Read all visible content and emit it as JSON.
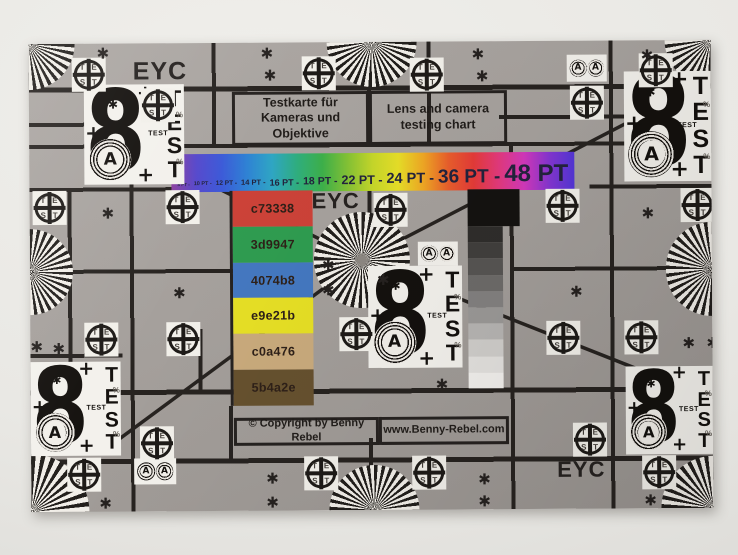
{
  "wall_color": "#ecebe7",
  "chart": {
    "background": "#a6a19d",
    "ink": "#262220",
    "eyc_label": "EYC",
    "title_de": {
      "line1": "Testkarte für",
      "line2": "Kameras und Objektive"
    },
    "title_en": {
      "line1": "Lens and camera",
      "line2": "testing chart"
    },
    "font_size_bar": {
      "labels": [
        "8 PT",
        "10 PT",
        "12 PT",
        "14 PT",
        "16 PT",
        "18 PT",
        "22 PT",
        "24 PT",
        "36 PT",
        "48 PT"
      ],
      "separator": "-",
      "text_color": "#23233d",
      "gradient_colors": [
        "#8b3f9e",
        "#5548cc",
        "#3c5ad8",
        "#2f82d4",
        "#2fa6c4",
        "#2fae7e",
        "#3db04a",
        "#84c235",
        "#c6d72a",
        "#e7df28",
        "#f0a824",
        "#ea5e2c",
        "#e53b38",
        "#e43a7e",
        "#d439bc",
        "#8636d2",
        "#5336d8"
      ]
    },
    "color_patches": [
      {
        "label": "c73338",
        "color": "#cc4238"
      },
      {
        "label": "3d9947",
        "color": "#2f9c50"
      },
      {
        "label": "4074b8",
        "color": "#4478c0"
      },
      {
        "label": "e9e21b",
        "color": "#e6df25"
      },
      {
        "label": "c0a476",
        "color": "#c9aa7c"
      },
      {
        "label": "5b4a2e",
        "color": "#66512f"
      }
    ],
    "grayscale": {
      "black_block": "#151311",
      "steps": [
        "#2f2d2b",
        "#413f3d",
        "#575553",
        "#6d6b69",
        "#838180",
        "#9b9997",
        "#b7b5b3",
        "#d0cecb",
        "#e3e1de",
        "#f2f0ed"
      ]
    },
    "footer": {
      "copyright": "© Copyright by Benny Rebel",
      "website": "www.Benny-Rebel.com"
    },
    "marks": {
      "crosshair_top": "TE",
      "crosshair_bottom": "ST",
      "figure_eight": "8",
      "test_vertical": "TEST",
      "test_small": "TEST",
      "circled_letter": "A",
      "asterisk": "✱",
      "plus": "+",
      "percent": "%"
    }
  }
}
